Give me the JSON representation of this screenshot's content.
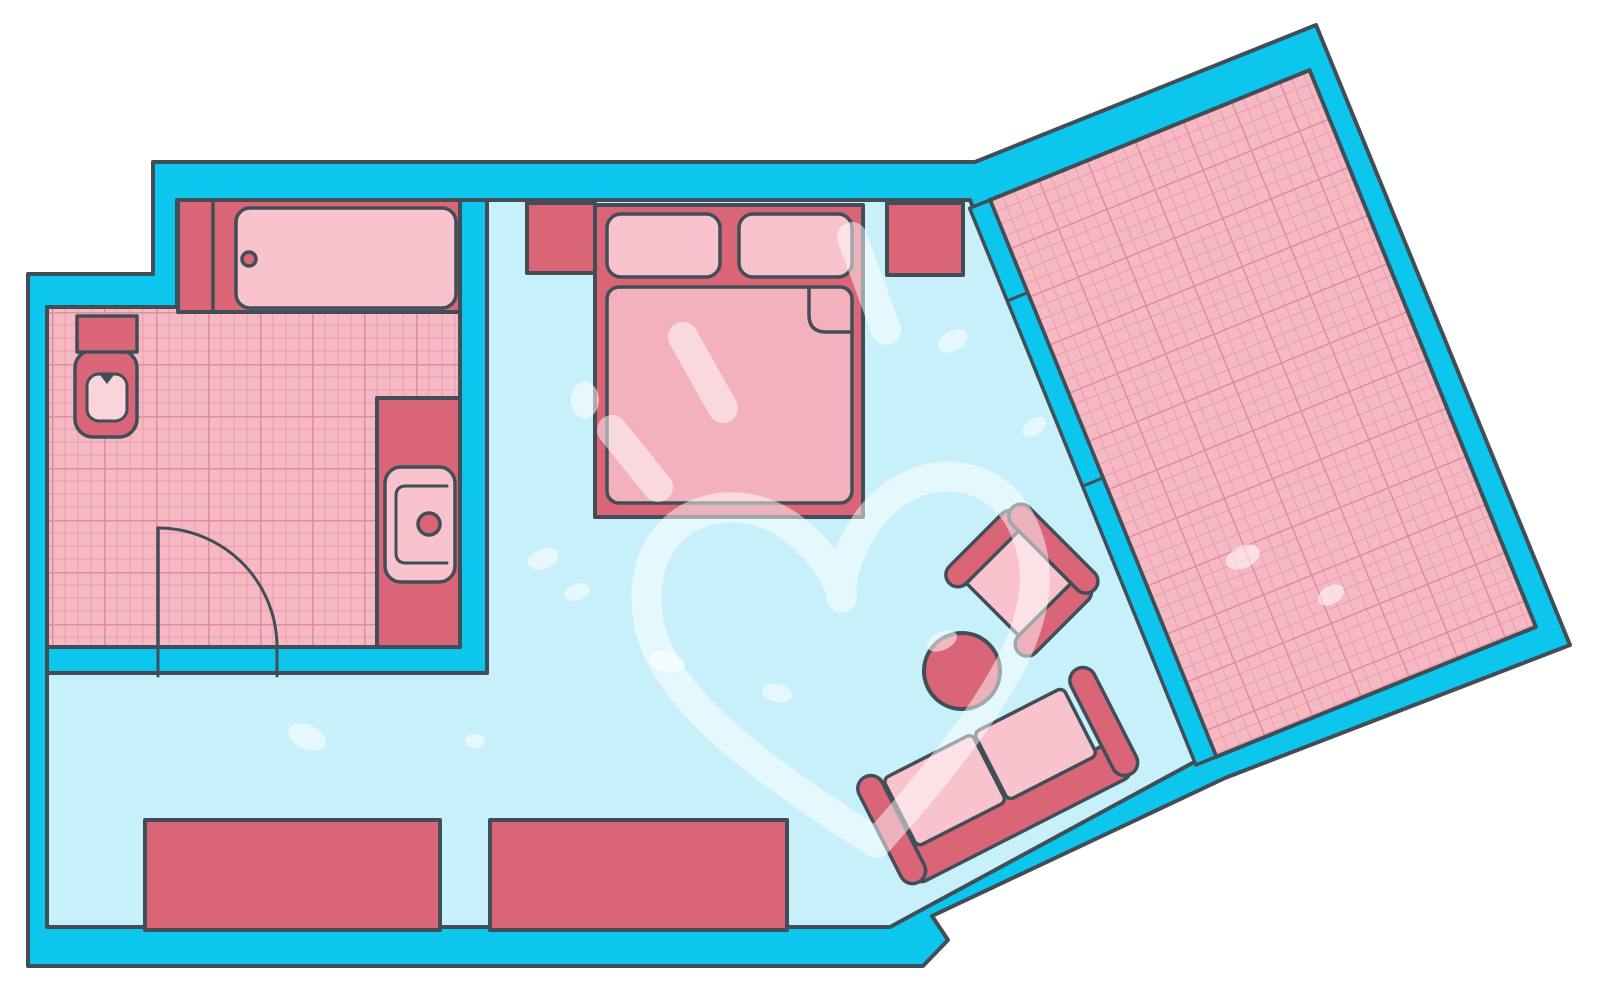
{
  "meta": {
    "title": "Apartment floor plan",
    "type": "floor-plan-diagram",
    "text_content": "none"
  },
  "palette": {
    "bg": "#ffffff",
    "wall": "#0cc6ee",
    "outline": "#414e57",
    "floor": "#c8f0fa",
    "tile": "#f6b9c4",
    "tile-line": "#e99dad",
    "tile-line-major": "#df8c9e",
    "dark": "#d96577",
    "light": "#f8c3cd",
    "lighter": "#fbd3da",
    "mattress": "#f3b0bd",
    "wm": "#ffffff"
  },
  "labels": {
    "plan": "Apartment floor plan",
    "bathroom": "Bathroom",
    "bathroom_floor": "Bathroom tiled floor",
    "main_room": "Main room",
    "terrace": "Tiled terrace room",
    "partition": "Partition wall with door joints",
    "outer_wall": "Exterior wall",
    "bathtub": "Bathtub",
    "bathtub_deck": "Bathtub deck",
    "drain": "Bathtub drain",
    "toilet": "Wall-hung toilet",
    "washbasin": "Washbasin on counter",
    "faucet": "Faucet",
    "door": "Bathroom door with swing arc",
    "bed": "Double bed",
    "pillow": "Pillow",
    "mattress": "Mattress with folded duvet corner",
    "nightstand_left": "Left nightstand",
    "nightstand_right": "Right nightstand",
    "cabinet_left": "Low cabinet left",
    "cabinet_right": "Low cabinet right",
    "table": "Round coffee table",
    "armchair": "Armchair",
    "sofa": "Two-seat sofa",
    "watermark": "White heart watermark"
  }
}
